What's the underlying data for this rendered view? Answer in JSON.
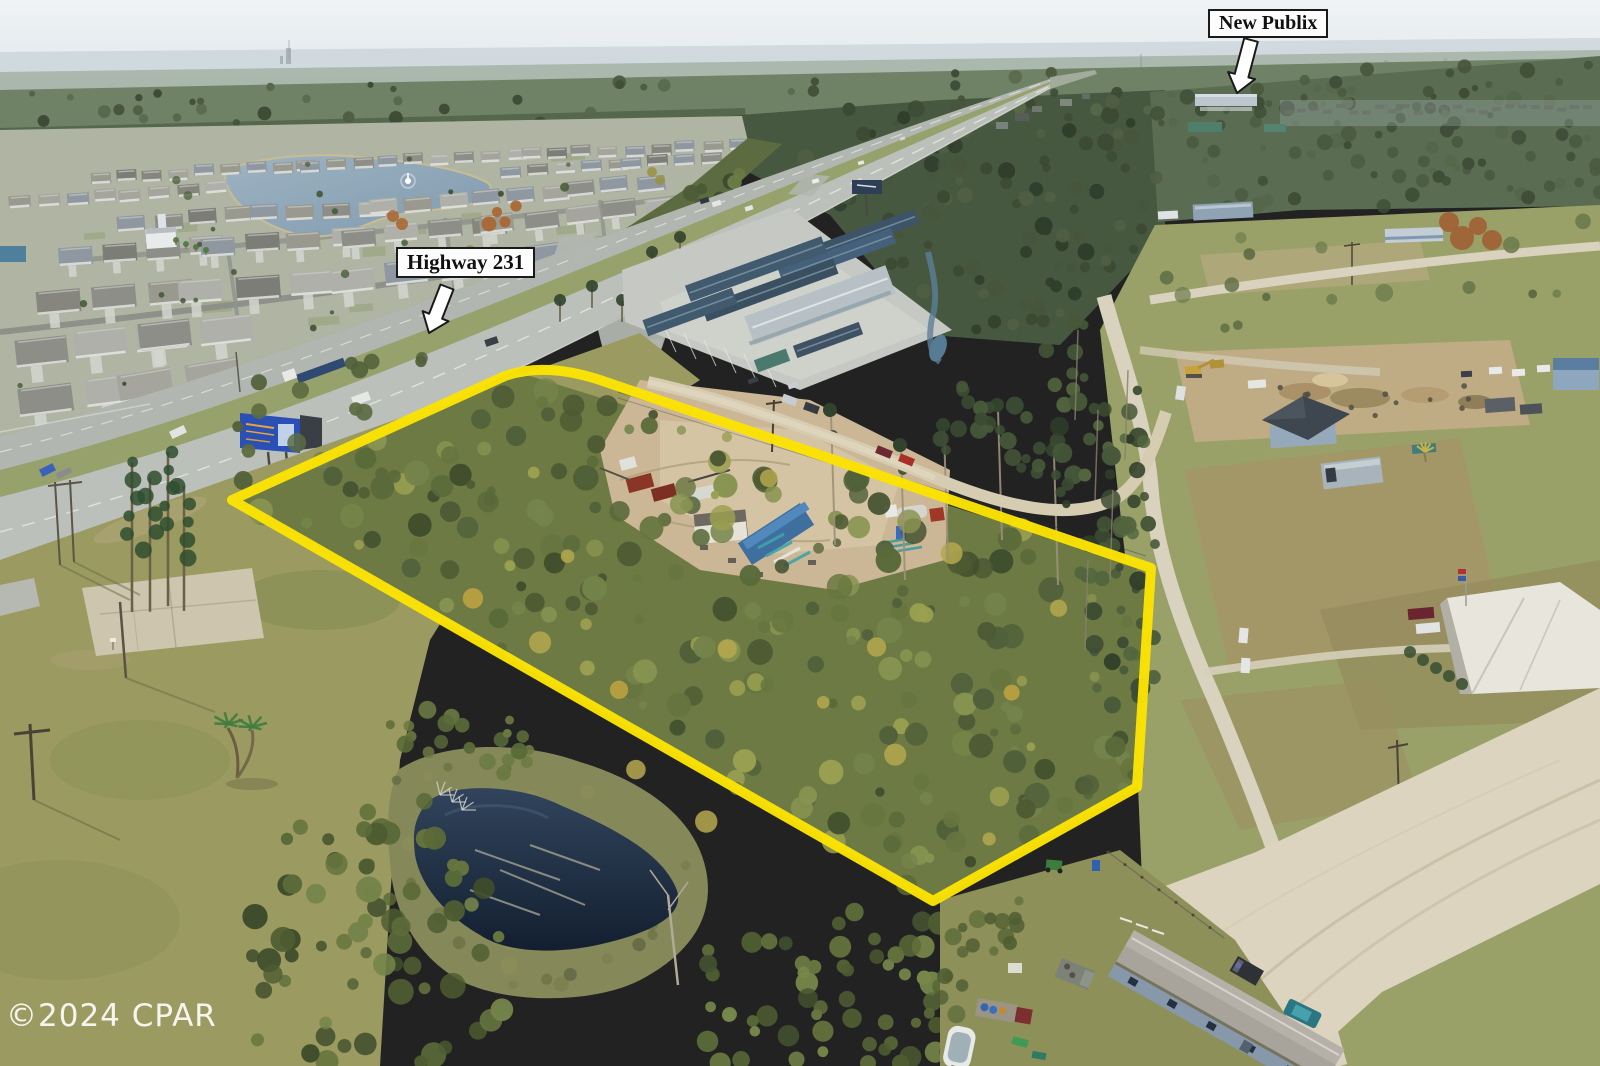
{
  "annotations": {
    "publix": {
      "label": "New Publix",
      "arrow_icon": "block-arrow-down-left"
    },
    "highway": {
      "label": "Highway 231",
      "arrow_icon": "block-arrow-down-left"
    }
  },
  "watermark": {
    "text": "©2024 CPAR"
  },
  "colors": {
    "property_outline": "#fbe303",
    "label_background": "#fdfdfd",
    "label_border": "#1a1a1a",
    "watermark_text": "#ffffff",
    "arrow_fill": "#ffffff",
    "arrow_stroke": "#1a1a1a"
  }
}
